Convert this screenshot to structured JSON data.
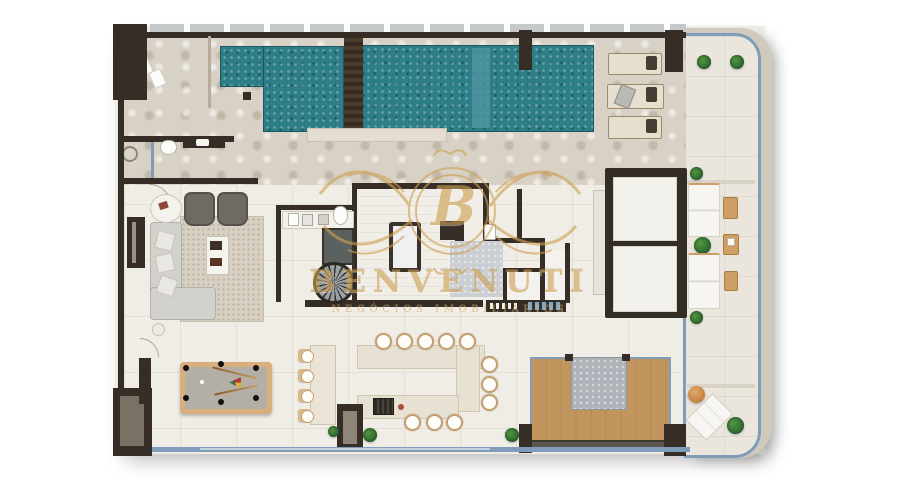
{
  "watermark": {
    "monogram": "B",
    "brand": "BENVENUTI",
    "tagline": "NEGÓCIOS IMOBILIÁRIOS"
  },
  "palette": {
    "pool": "#2e7e88",
    "gold": "#cda053",
    "wall": "#362e26",
    "glass": "#7f9db9",
    "wood": "#c2955f",
    "deckstone": "#d8d1c5",
    "floor": "#f0ede7",
    "terrace": "#eae6de",
    "felt": "#b3afa7",
    "billiard_wood": "#d8ae7d",
    "plant": "#2f6b33"
  },
  "features": [
    "swimming-pool",
    "pool-deck",
    "sun-loungers",
    "balcony-terrace",
    "planters",
    "living-room-sofa",
    "armchairs",
    "coffee-table",
    "tv-panel",
    "rug",
    "kitchen-counter",
    "spiral-staircase",
    "bathtub",
    "powder-room",
    "daybeds",
    "balcony-sofas",
    "side-tables",
    "billiard-table",
    "bar-counter",
    "bar-stools",
    "dining-table",
    "dining-chairs",
    "barbecue-grill",
    "fireplace",
    "wood-deck",
    "spa-block",
    "lounge-chair",
    "pouf"
  ]
}
